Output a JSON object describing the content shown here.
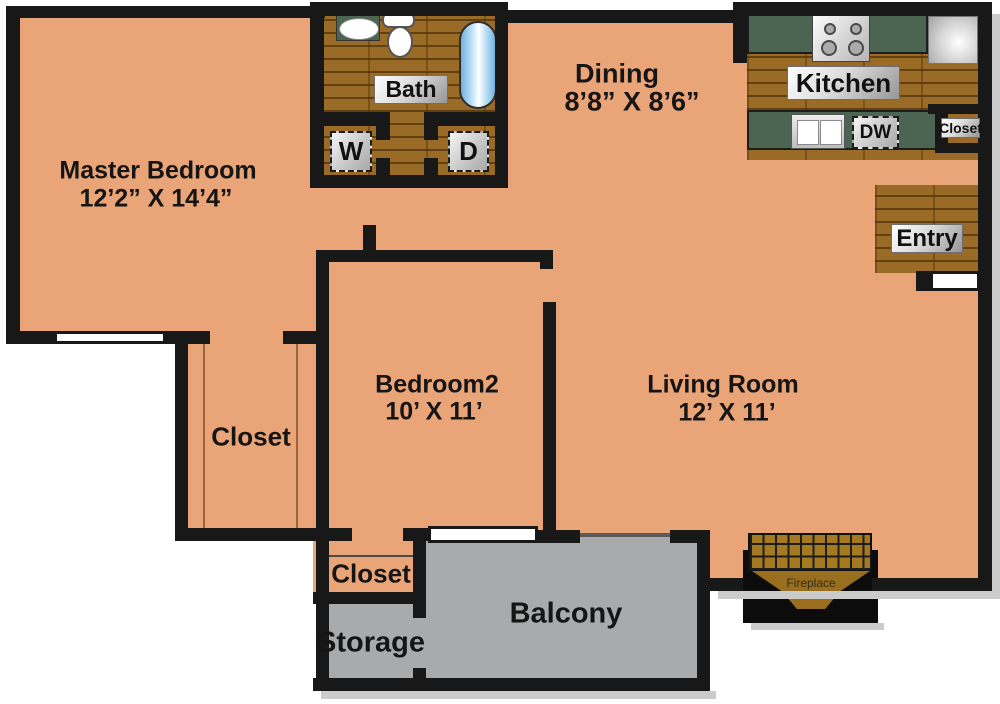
{
  "title": "Apartment Floor Plan",
  "rooms": {
    "master": {
      "name": "Master Bedroom",
      "dims": "12’2” X 14’4”"
    },
    "dining": {
      "name": "Dining",
      "dims": "8’8” X 8’6”"
    },
    "bedroom2": {
      "name": "Bedroom2",
      "dims": "10’ X 11’"
    },
    "living": {
      "name": "Living Room",
      "dims": "12’ X 11’"
    },
    "bath": {
      "name": "Bath"
    },
    "kitchen": {
      "name": "Kitchen"
    },
    "entry": {
      "name": "Entry"
    },
    "walkin_closet": {
      "name": "Closet"
    },
    "kitchen_closet": {
      "name": "Closet"
    },
    "bedroom2_closet": {
      "name": "Closet"
    },
    "storage": {
      "name": "Storage"
    },
    "balcony": {
      "name": "Balcony"
    },
    "fireplace": {
      "name": "Fireplace"
    }
  },
  "appliances": {
    "washer": "W",
    "dryer": "D",
    "dishwasher": "DW"
  },
  "fixtures": [
    "bathtub",
    "toilet",
    "bath-sink",
    "stove",
    "refrigerator",
    "kitchen-sink",
    "fireplace-hearth",
    "window",
    "sliding-door",
    "entry-door"
  ],
  "colors": {
    "room_salmon": "#E9A478",
    "wood_floor": "#996B27",
    "counter_green": "#4C6553",
    "concrete_gray": "#A9AAAC",
    "wall_black": "#181818",
    "tub_blue": "#8FC6EC"
  }
}
